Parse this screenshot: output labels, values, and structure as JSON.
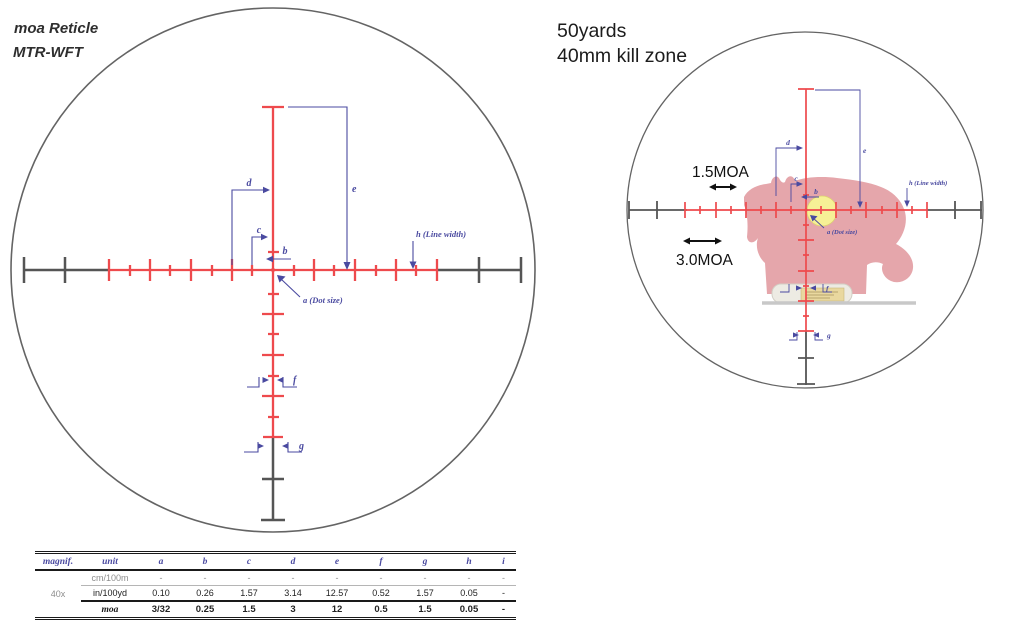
{
  "colors": {
    "reticle_red": "#ee4a4d",
    "dimension_blue": "#4a4aa0",
    "line_dark": "#555555",
    "circle_gray": "#646464",
    "rat_pink": "#e5a6ab",
    "killzone_yellow": "#f6f096",
    "platform_gray": "#c8c8c8",
    "table_blue": "#4a4aa0"
  },
  "left_diagram": {
    "title": "moa Reticle",
    "subtitle": "MTR-WFT",
    "labels": {
      "a": "a (Dot size)",
      "b": "b",
      "c": "c",
      "d": "d",
      "e": "e",
      "f": "f",
      "g": "g",
      "h": "h (Line width)"
    }
  },
  "right_diagram": {
    "title_line1": "50yards",
    "title_line2": "40mm kill zone",
    "annotation_small": "1.5MOA",
    "annotation_large": "3.0MOA",
    "labels": {
      "a": "a (Dot size)",
      "b": "b",
      "c": "c",
      "d": "d",
      "e": "e",
      "f": "f",
      "g": "g",
      "h": "h (Line width)"
    }
  },
  "spec_table": {
    "headers": [
      "magnif.",
      "unit",
      "a",
      "b",
      "c",
      "d",
      "e",
      "f",
      "g",
      "h",
      "i"
    ],
    "magnification": "40x",
    "rows": [
      {
        "unit": "cm/100m",
        "values": [
          "-",
          "-",
          "-",
          "-",
          "-",
          "-",
          "-",
          "-",
          "-"
        ]
      },
      {
        "unit": "in/100yd",
        "values": [
          "0.10",
          "0.26",
          "1.57",
          "3.14",
          "12.57",
          "0.52",
          "1.57",
          "0.05",
          "-"
        ]
      },
      {
        "unit": "moa",
        "values": [
          "3/32",
          "0.25",
          "1.5",
          "3",
          "12",
          "0.5",
          "1.5",
          "0.05",
          "-"
        ]
      }
    ]
  }
}
